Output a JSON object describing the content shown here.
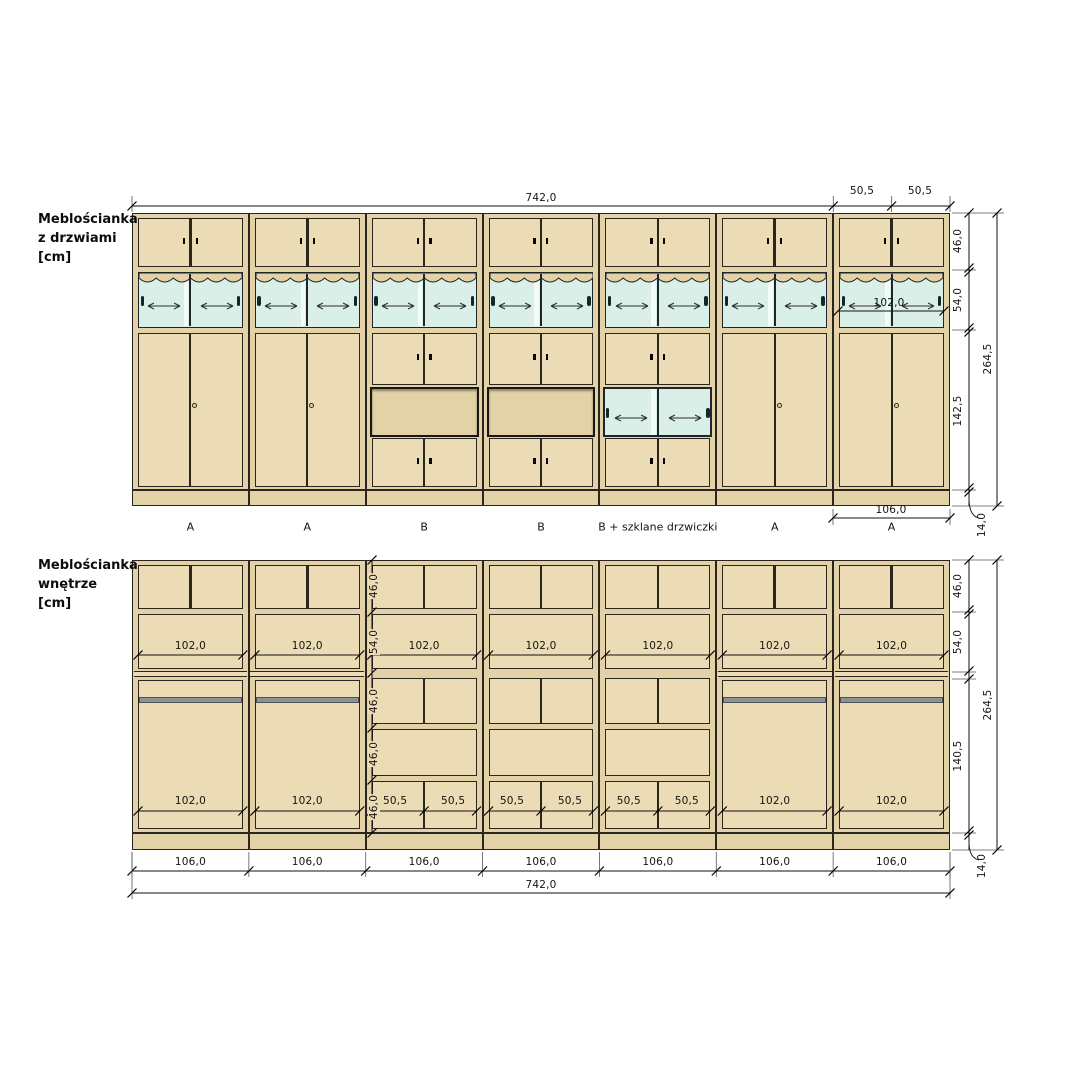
{
  "titles": {
    "top_line1": "Meblościanka",
    "top_line2": "z drzwiami",
    "top_line3": "[cm]",
    "bottom_line1": "Meblościanka",
    "bottom_line2": "wnętrze",
    "bottom_line3": "[cm]"
  },
  "top_drawing": {
    "column_types": [
      "A",
      "A",
      "B",
      "B",
      "Bg",
      "A",
      "A"
    ],
    "section_labels": [
      "A",
      "A",
      "B",
      "B",
      "B + szklane drzwiczki",
      "A",
      "A"
    ],
    "dims": {
      "overall_width": "742,0",
      "door_half_widths": [
        "50,5",
        "50,5"
      ],
      "glass_opening_width": "102,0",
      "module_width": "106,0",
      "top_section_height": "46,0",
      "glass_section_height": "54,0",
      "lower_door_height": "142,5",
      "total_height": "264,5",
      "plinth_height": "14,0"
    }
  },
  "bottom_drawing": {
    "column_types": [
      "A",
      "A",
      "B",
      "B",
      "B",
      "A",
      "A"
    ],
    "dims": {
      "module_widths": [
        "106,0",
        "106,0",
        "106,0",
        "106,0",
        "106,0",
        "106,0",
        "106,0"
      ],
      "overall_width": "742,0",
      "interior_width": "102,0",
      "half_interior_width": "50,5",
      "left_heights": [
        "46,0",
        "54,0",
        "46,0",
        "46,0",
        "46,0"
      ],
      "top_section_height": "46,0",
      "glass_section_height": "54,0",
      "wardrobe_height": "140,5",
      "total_height": "264,5",
      "plinth_height": "14,0"
    }
  },
  "colors": {
    "wood": "#e3d2a8",
    "wood-light": "#ecdcb6",
    "frame": "#2b261d",
    "glass": "#d9efe8",
    "glass-light": "#f1fbf7",
    "rod": "#8f9294",
    "ink": "#141410",
    "background": "#ffffff"
  }
}
